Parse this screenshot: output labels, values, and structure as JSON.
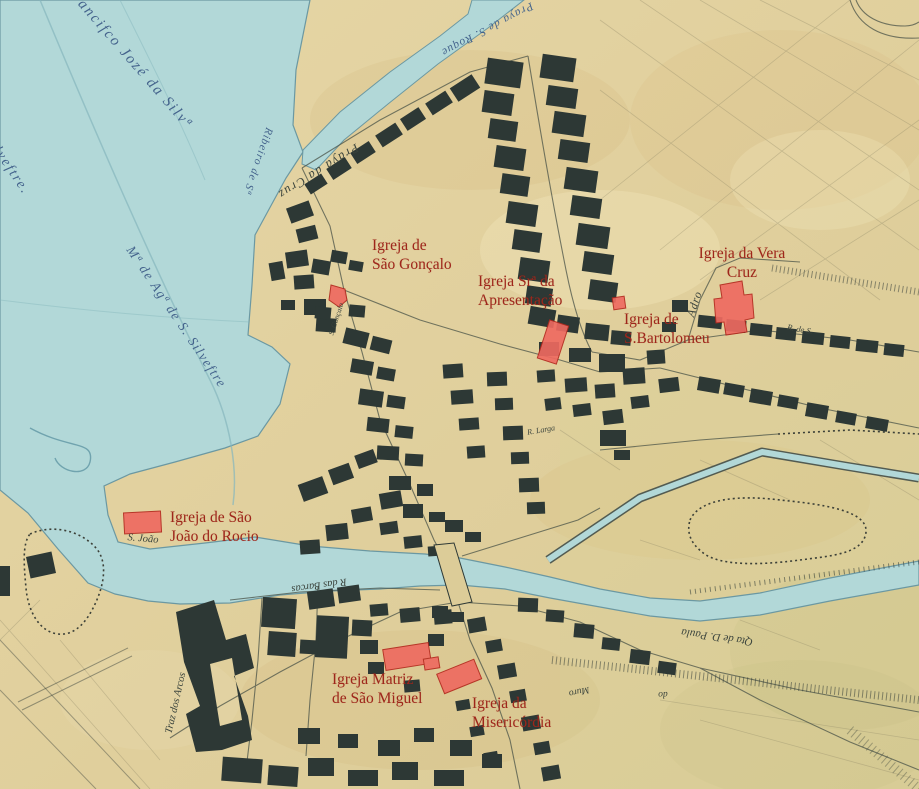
{
  "map": {
    "colors": {
      "parchment": "#e0cf9c",
      "water": "#b2d8d8",
      "ink_buildings": "#2d3835",
      "church_fill": "#ee6a60",
      "church_outline": "#b3291e",
      "church_label_text": "#9e261b",
      "blue_ink_text": "#44638c",
      "dark_ink_text": "#3a433c"
    },
    "church_labels": [
      {
        "id": "sao-goncalo",
        "line1": "Igreja de",
        "line2": "São Gonçalo"
      },
      {
        "id": "apresentacao",
        "line1": "Igreja Srª da",
        "line2": "Apresentação"
      },
      {
        "id": "vera-cruz",
        "line1": "Igreja da Vera",
        "line2": "Cruz"
      },
      {
        "id": "bartolomeu",
        "line1": "Igreja de",
        "line2": "S.Bartolomeu"
      },
      {
        "id": "rocio",
        "line1": "Igreja de São",
        "line2": "João do Rocio"
      },
      {
        "id": "matriz",
        "line1": "Igreja Matriz",
        "line2": "de São Miguel"
      },
      {
        "id": "misericordia",
        "line1": "Igreja da",
        "line2": "Misericórdia"
      }
    ],
    "ink_labels": [
      {
        "id": "francisco-silva",
        "text": "Francifco Jozé da Silvª"
      },
      {
        "id": "s-silvestre",
        "text": "de S. Silveftre."
      },
      {
        "id": "ribeiro",
        "text": "Ribeiro de Sª"
      },
      {
        "id": "praca-roque",
        "text": "Praya de S. Roque"
      },
      {
        "id": "praca-cruz",
        "text": "Praya da Cruz"
      },
      {
        "id": "mae-agua",
        "text": "Mª de Agª de S. Silveftre"
      },
      {
        "id": "s-joao",
        "text": "S. João"
      },
      {
        "id": "s-goncalo-small",
        "text": "S. Gonçalo"
      },
      {
        "id": "adro",
        "text": "Adro"
      },
      {
        "id": "r-das-barcas",
        "text": "R das Barcas"
      },
      {
        "id": "qta-paula",
        "text": "Qta de D. Paula"
      },
      {
        "id": "traz-arcos",
        "text": "Traz dos Arcos"
      },
      {
        "id": "muro",
        "text": "Muro"
      },
      {
        "id": "do",
        "text": "do"
      },
      {
        "id": "r-de-s",
        "text": "R. de S."
      },
      {
        "id": "r-larga",
        "text": "R. Larga"
      }
    ]
  }
}
